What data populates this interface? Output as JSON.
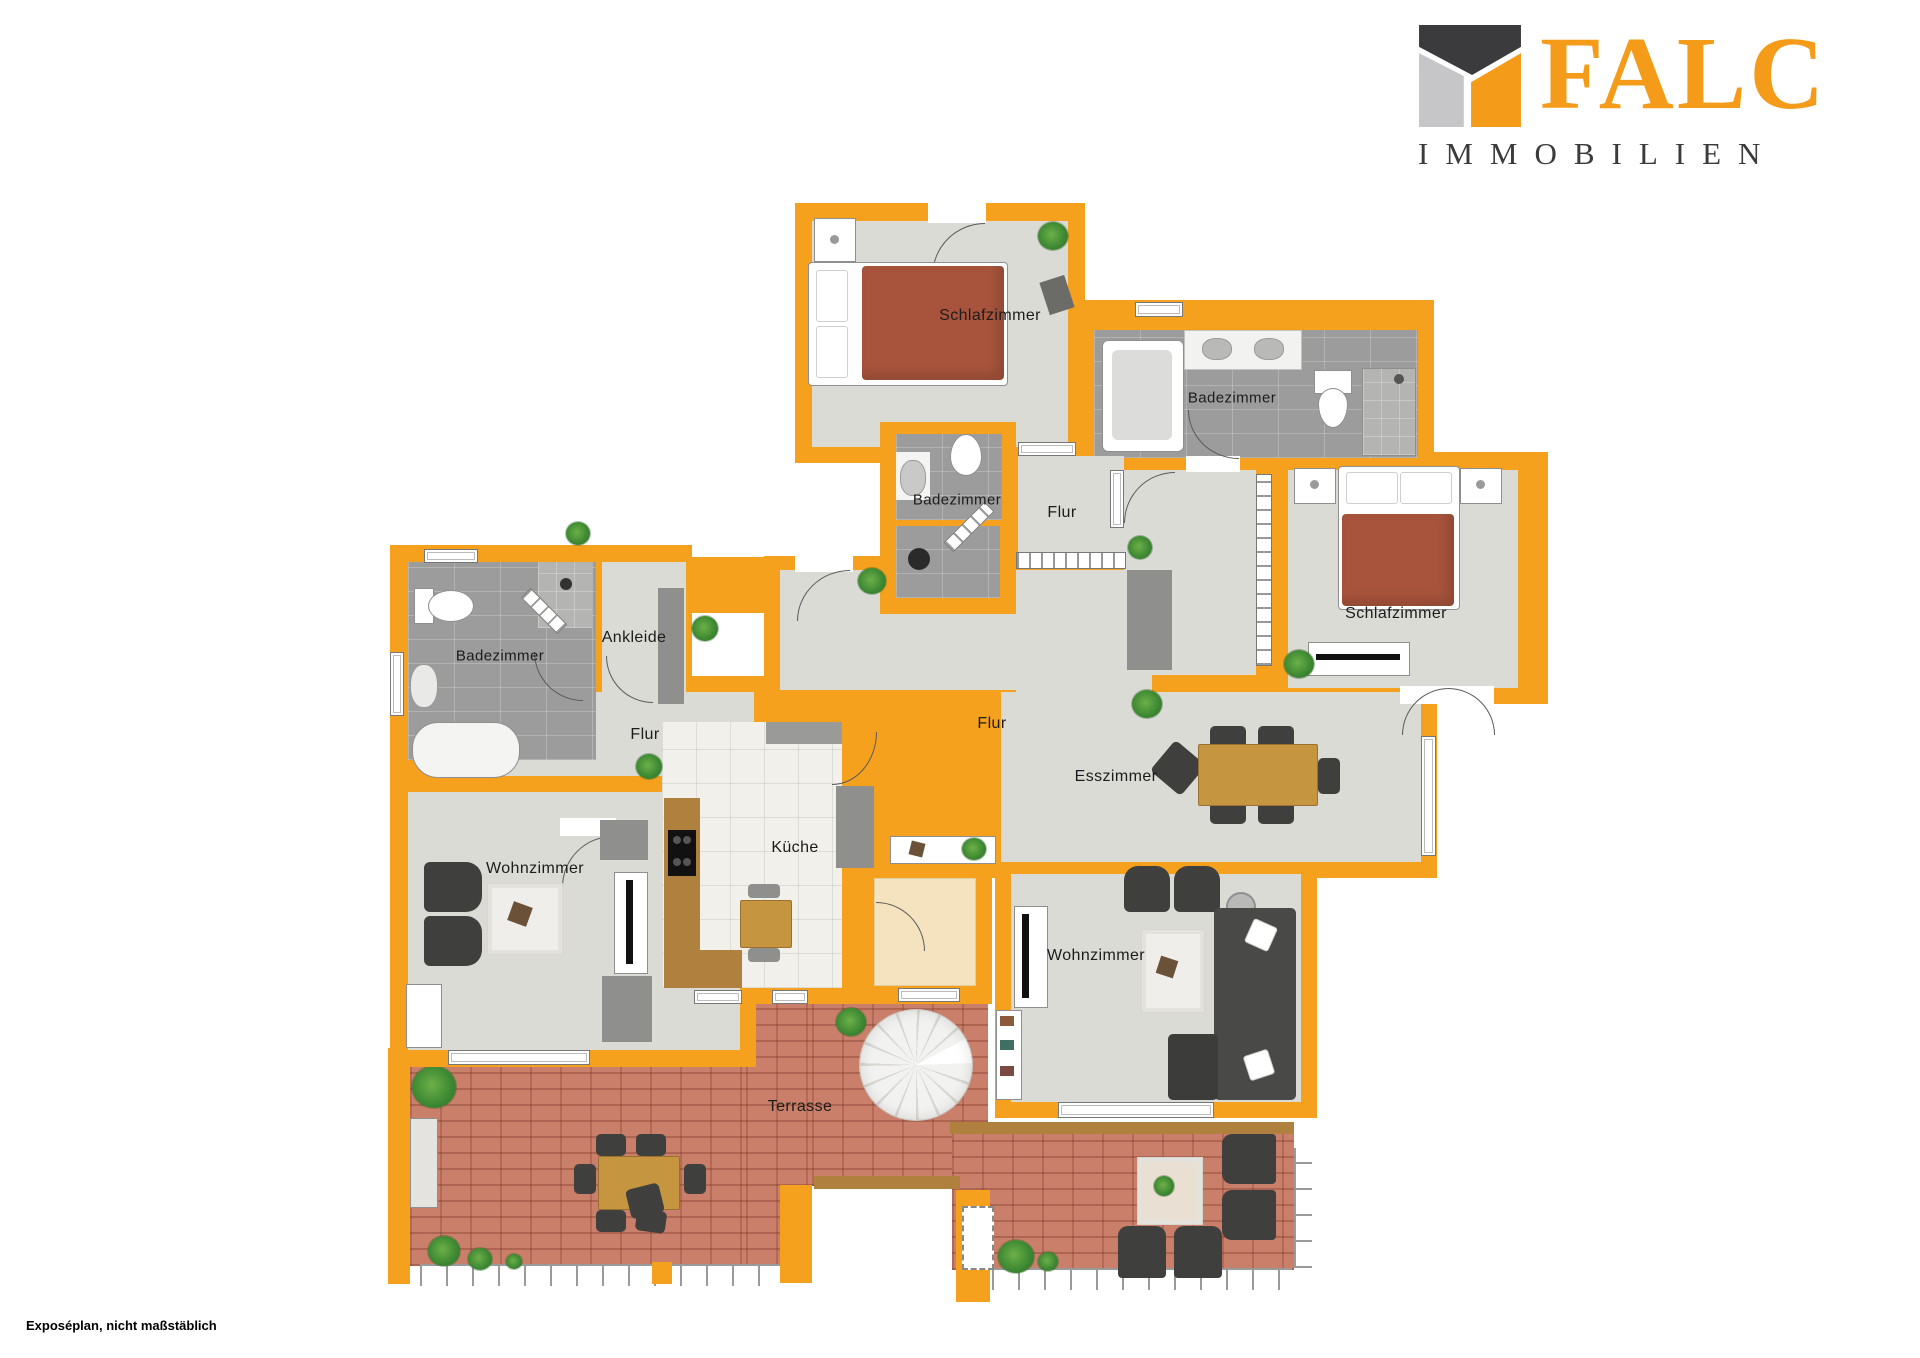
{
  "brand": {
    "name": "FALC",
    "subtitle": "IMMOBILIEN"
  },
  "footer": {
    "note": "Exposéplan, nicht maßstäblich"
  },
  "colors": {
    "wall_orange": "#F5A11E",
    "floor_gray": "#DBDBD6",
    "bath_tile_gray": "#9C9C9C",
    "terrace_brick": "#C97F69",
    "bed_blanket_rust": "#A8543C",
    "logo_orange": "#F49C19",
    "logo_dark": "#3B3A3C"
  },
  "rooms": {
    "schlafzimmer_top": "Schlafzimmer",
    "badezimmer_top_right": "Badezimmer",
    "badezimmer_middle": "Badezimmer",
    "flur_top": "Flur",
    "schlafzimmer_right": "Schlafzimmer",
    "badezimmer_left": "Badezimmer",
    "ankleide": "Ankleide",
    "flur_left": "Flur",
    "flur_center": "Flur",
    "esszimmer": "Esszimmer",
    "wohnzimmer_left": "Wohnzimmer",
    "kueche": "Küche",
    "wohnzimmer_right": "Wohnzimmer",
    "terrasse": "Terrasse"
  }
}
